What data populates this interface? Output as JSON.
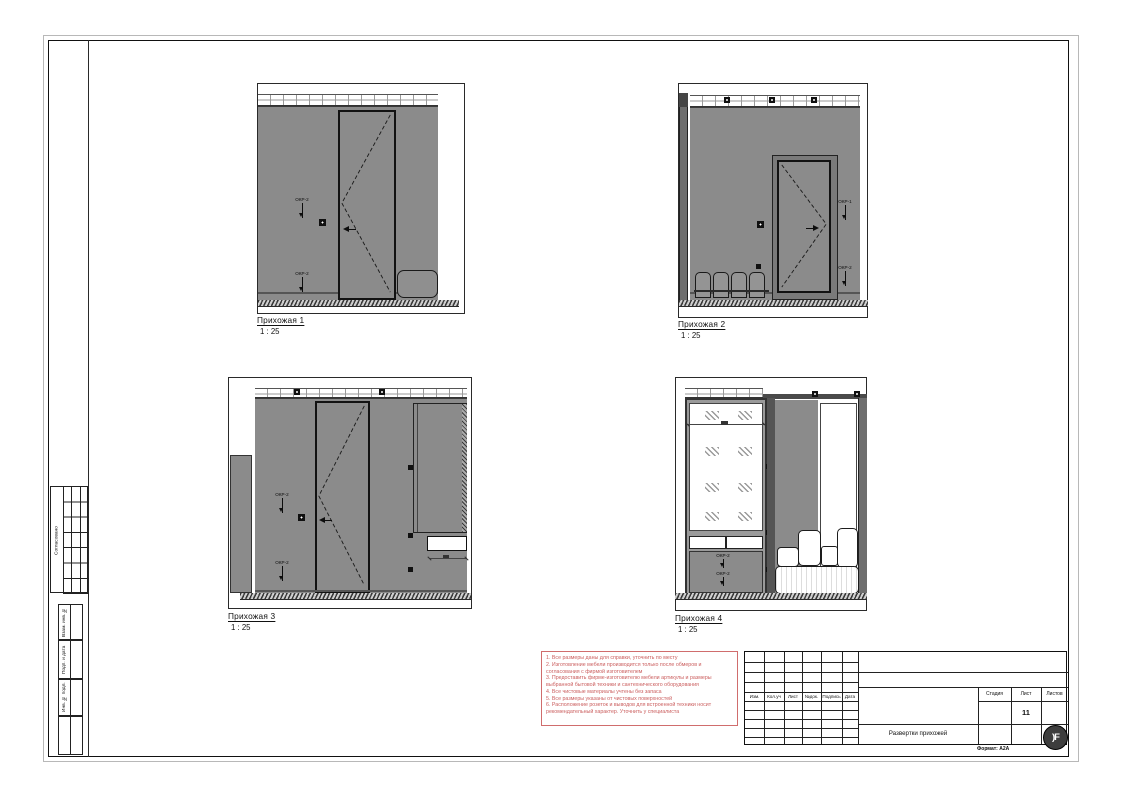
{
  "sheet": {
    "format_label": "Формат: А2А",
    "logo_text": ")F"
  },
  "side_strip": {
    "approved": "Согласовано",
    "alt_inv": "Взам. инв. №",
    "sign_date": "Подп. и дата",
    "inv_orig": "Инв. № подл."
  },
  "views": [
    {
      "title": "Прихожая 1",
      "scale": "1 : 25"
    },
    {
      "title": "Прихожая 2",
      "scale": "1 : 25"
    },
    {
      "title": "Прихожая 3",
      "scale": "1 : 25"
    },
    {
      "title": "Прихожая 4",
      "scale": "1 : 25"
    }
  ],
  "callouts": {
    "okr1": "ОКР-1",
    "okr2": "ОКР-2"
  },
  "notes": {
    "lines": [
      "1. Все размеры даны для справки, уточнить по месту",
      "2. Изготовление мебели производится только после обмеров и согласования с фирмой изготовителем",
      "3. Предоставить фирме-изготовителю мебели артикулы и размеры выбранной бытовой техники и сантехнического оборудования",
      "4. Все чистовые материалы учтены без запаса",
      "5. Все размеры указаны от чистовых поверхностей",
      "6. Расположение розеток и выводов для встроенной техники носит рекомендательный характер. Уточнить у специалиста"
    ]
  },
  "titleblock": {
    "rev_cols": [
      "Изм.",
      "Кол.уч",
      "Лист",
      "№док.",
      "Подпись",
      "Дата"
    ],
    "stage": "Стадия",
    "sheet": "Лист",
    "sheets": "Листов",
    "sheet_number": "11",
    "drawing_title": "Развертки прихожей"
  },
  "colors": {
    "wall": "#8b8b8b",
    "note_red": "#cf6868"
  }
}
